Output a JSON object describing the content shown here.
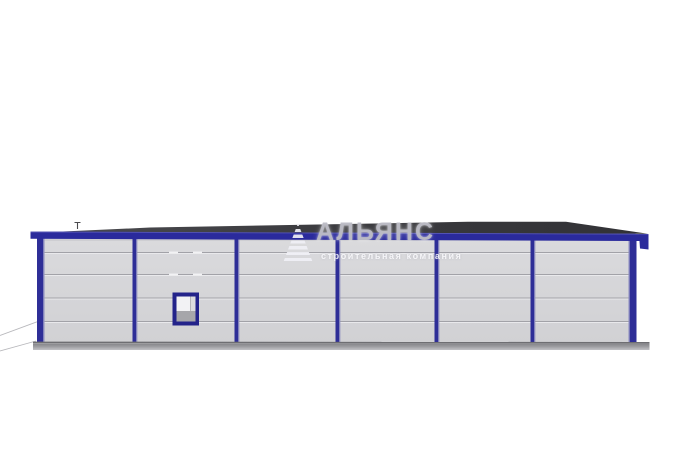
{
  "watermark": {
    "brand": "АЛЬЯНС",
    "tagline": "строительная компания"
  },
  "scene": {
    "description": "Side elevation 3D render of a long single-storey prefabricated metal building with sandwich-panel walls, blue steel frame columns, one small window and a flat dark roof",
    "background": "#ffffff",
    "building": {
      "bays": 6,
      "panel_rows": 5,
      "window_count": 1,
      "colors": {
        "frame_blue": "#2b2b9b",
        "frame_highlight": "#9898c4",
        "wall_gray": "#d6d6d9",
        "panel_line_gray": "#a2a2a8",
        "roof_dark": "#3a3a3e",
        "fascia_blue": "#2a2a9c",
        "base_gray": "#99999d",
        "window_frame_blue": "#23238a",
        "window_glass": "#f2f2f4",
        "window_sill_gray": "#a6a6aa"
      }
    }
  }
}
